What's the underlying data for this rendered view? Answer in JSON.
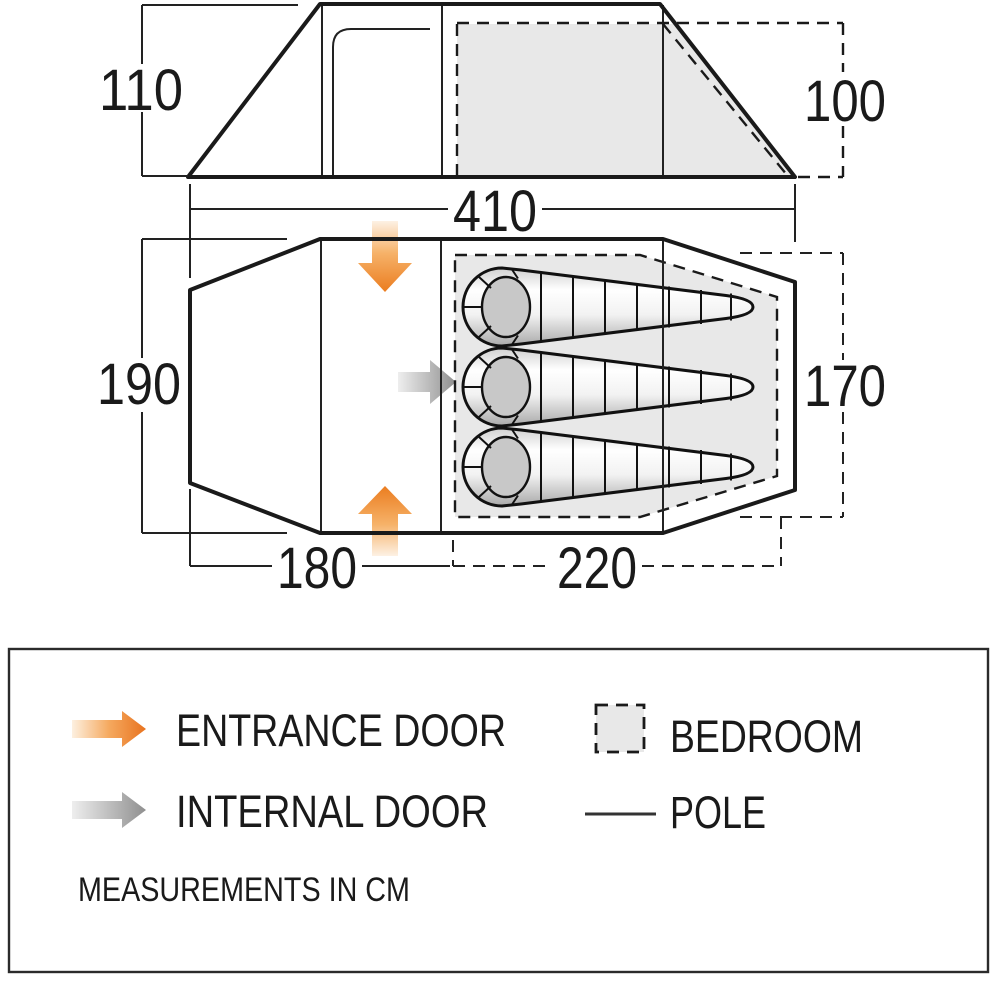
{
  "title": "Tent floor plan diagram",
  "units": "cm",
  "sleeping_bag_count": 3,
  "dimensions": {
    "side_left_height": "110",
    "side_right_height": "100",
    "total_length": "410",
    "plan_left_width": "190",
    "plan_right_width": "170",
    "living_length": "180",
    "bedroom_length": "220"
  },
  "legend": {
    "entrance_door_label": "ENTRANCE DOOR",
    "internal_door_label": "INTERNAL DOOR",
    "bedroom_label": "BEDROOM",
    "pole_label": "POLE",
    "note": "MEASUREMENTS IN CM"
  },
  "colors": {
    "outline": "#1a1a1a",
    "bedroom_fill": "#e8e8e8",
    "entrance_arrow_orange": "#eb7d20",
    "internal_arrow_gray": "#8f8f8f"
  }
}
